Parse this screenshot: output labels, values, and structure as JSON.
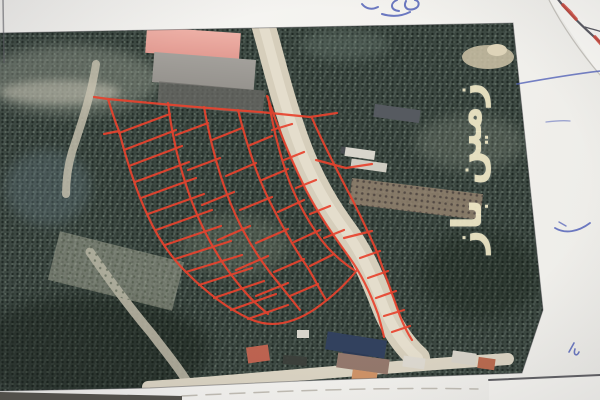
{
  "watermark": {
    "text": "زمین باز",
    "color": "#eee6c4"
  },
  "colors": {
    "parcel_boundary_red": "#e8432e",
    "road_beige": "#d6cebb",
    "road_center": "#e7e1d1",
    "orchard_dark_green": "#3e4b44",
    "pink_field": "#e9a49b",
    "gray_field": "#9e9b94",
    "paper_white": "#f3f2ee",
    "pen_blue": "#4a5ab5",
    "pen_dark": "#5a5a62",
    "annotation_red": "#d0493c",
    "sheet_edge_dark": "#46464c"
  }
}
